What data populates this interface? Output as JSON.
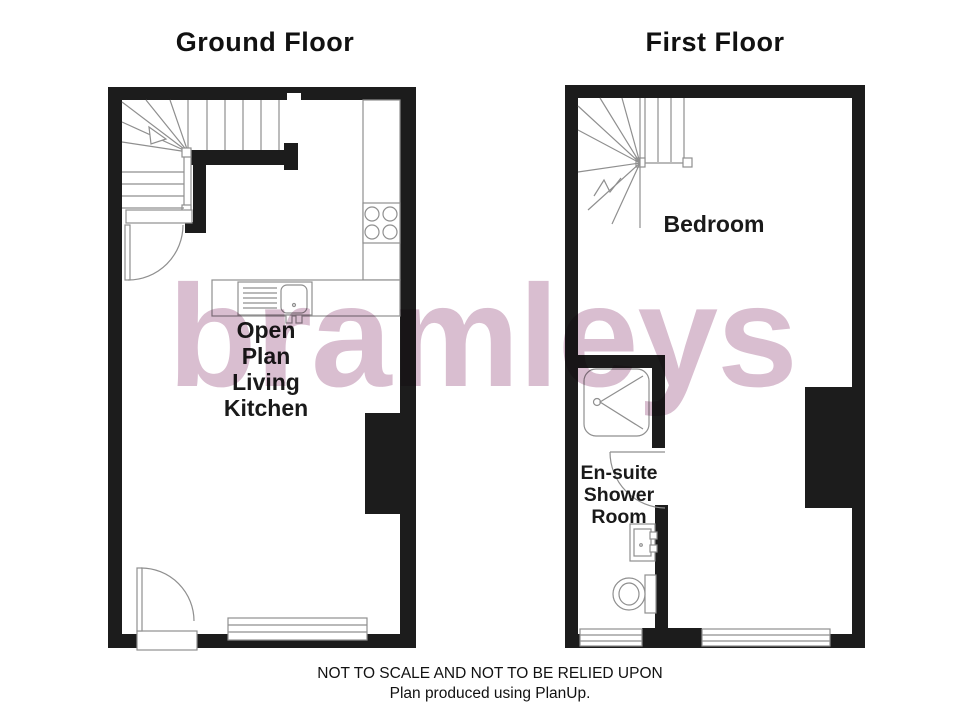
{
  "titles": {
    "ground_floor": "Ground Floor",
    "first_floor": "First Floor"
  },
  "labels": {
    "ground_floor_room": [
      "Open",
      "Plan",
      "Living",
      "Kitchen"
    ],
    "first_floor_bedroom": "Bedroom",
    "first_floor_ensuite": [
      "En-suite",
      "Shower",
      "Room"
    ]
  },
  "watermark": {
    "text": "bramleys",
    "color": "#d9bed0"
  },
  "footer": {
    "line1": "NOT TO SCALE AND NOT TO BE RELIED UPON",
    "line2": "Plan produced using PlanUp."
  },
  "colors": {
    "wall": "#1c1c1c",
    "fixture_line": "#8f8f8f",
    "text": "#1a1a1a"
  }
}
